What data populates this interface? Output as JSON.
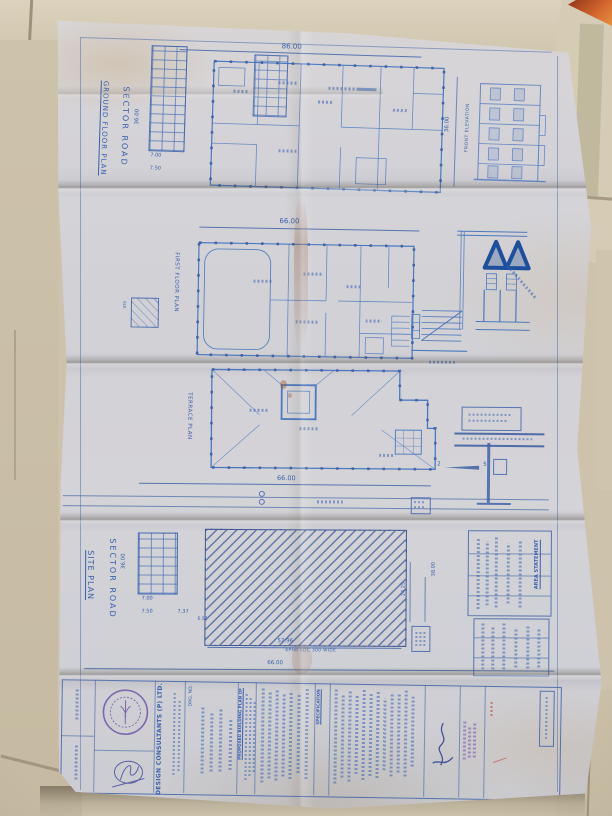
{
  "ground_floor": {
    "road_label": "SECTOR ROAD",
    "title": "GROUND FLOOR PLAN",
    "dim_top": "86.00",
    "dim_left": "36.00",
    "dim_right": "36.00",
    "bay_a": "7.00",
    "bay_b": "7.50",
    "elevation_title": "FRONT ELEVATION"
  },
  "first_floor": {
    "title": "FIRST FLOOR PLAN",
    "dim_top": "66.00",
    "lift_label": "ELE"
  },
  "terrace": {
    "title": "TERRACE PLAN",
    "dim_bottom": "66.00",
    "detail_ref_a": "2",
    "detail_ref_b": "5"
  },
  "site": {
    "road_label": "SECTOR ROAD",
    "title": "SITE PLAN",
    "dim_left": "36.00",
    "bay_a": "7.00",
    "bay_b": "7.50",
    "bay_c": "7.37",
    "dim_step": "6.57",
    "dim_building": "57.96",
    "road_note": "KPHB LDC 300 WIDE",
    "dim_plot": "66.00",
    "dim_right_a": "38.00",
    "dim_right_b": "24.25",
    "table_title": "AREA STATEMENT"
  },
  "title_block": {
    "firm": "JA DESIGN CONSULTANTS (P) LTD.",
    "drg_label": "DRG. NO.",
    "project_line1": "PROPOSED BUILDING PLAN OF",
    "spec_title": "SPECIFICATION"
  }
}
